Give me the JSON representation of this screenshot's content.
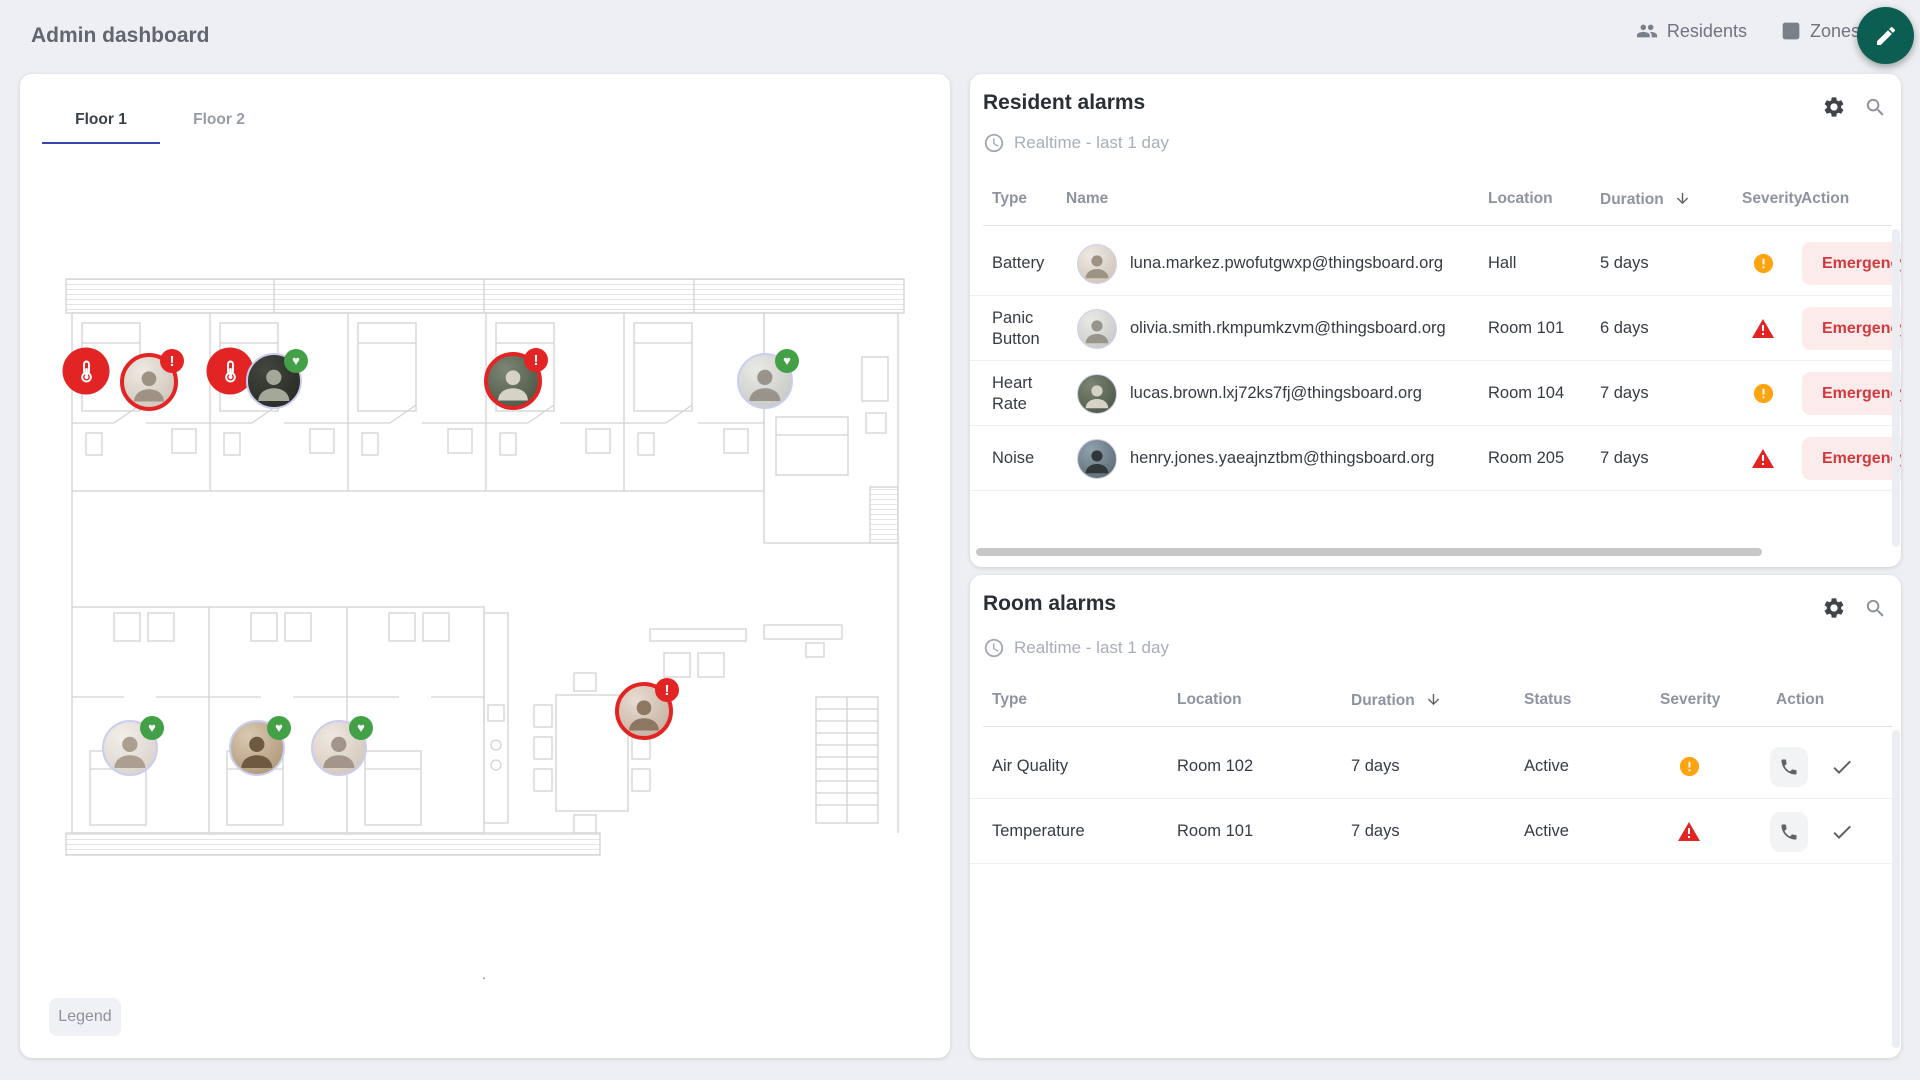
{
  "topbar": {
    "title": "Admin dashboard",
    "residents_button": "Residents",
    "zones_button": "Zones"
  },
  "floor": {
    "tabs": [
      {
        "label": "Floor 1",
        "active": true
      },
      {
        "label": "Floor 2",
        "active": false
      }
    ],
    "legend_button": "Legend",
    "dot_label": ".",
    "markers": [
      {
        "kind": "sensor",
        "icon": "thermometer-icon",
        "status": "alarm",
        "x": 22,
        "y": 94
      },
      {
        "kind": "resident",
        "photo": "woman-silver",
        "status": "alarm",
        "badge": "alert",
        "x": 85,
        "y": 105
      },
      {
        "kind": "sensor",
        "icon": "thermometer-icon",
        "status": "alarm",
        "x": 166,
        "y": 94
      },
      {
        "kind": "resident",
        "photo": "man-dark2",
        "status": "ok",
        "badge": "heart",
        "x": 210,
        "y": 104
      },
      {
        "kind": "resident",
        "photo": "man-gray",
        "status": "alarm",
        "badge": "alert",
        "x": 449,
        "y": 104
      },
      {
        "kind": "resident",
        "photo": "woman-white",
        "status": "ok",
        "badge": "heart",
        "x": 701,
        "y": 104
      },
      {
        "kind": "resident",
        "photo": "woman-glasses",
        "status": "ok",
        "badge": "heart",
        "x": 66,
        "y": 471
      },
      {
        "kind": "resident",
        "photo": "man-cap",
        "status": "ok",
        "badge": "heart",
        "x": 193,
        "y": 471
      },
      {
        "kind": "resident",
        "photo": "woman-2",
        "status": "ok",
        "badge": "heart",
        "x": 275,
        "y": 471
      },
      {
        "kind": "resident",
        "photo": "woman-gray",
        "status": "alarm",
        "badge": "alert",
        "x": 580,
        "y": 434
      }
    ]
  },
  "resident_alarms": {
    "title": "Resident alarms",
    "timewindow": "Realtime - last 1 day",
    "columns": {
      "type": "Type",
      "name": "Name",
      "location": "Location",
      "duration": "Duration",
      "severity": "Severity",
      "action": "Action"
    },
    "sorted_by": "Duration",
    "rows": [
      {
        "type": "Battery",
        "avatar": "woman-silver",
        "name": "luna.markez.pwofutgwxp@thingsboard.org",
        "location": "Hall",
        "duration": "5 days",
        "severity": "warning",
        "action": "Emergency"
      },
      {
        "type": "Panic Button",
        "avatar": "woman-white",
        "name": "olivia.smith.rkmpumkzvm@thingsboard.org",
        "location": "Room 101",
        "duration": "6 days",
        "severity": "critical",
        "action": "Emergency"
      },
      {
        "type": "Heart Rate",
        "avatar": "man-gray",
        "name": "lucas.brown.lxj72ks7fj@thingsboard.org",
        "location": "Room 104",
        "duration": "7 days",
        "severity": "warning",
        "action": "Emergency"
      },
      {
        "type": "Noise",
        "avatar": "man-dark",
        "name": "henry.jones.yaeajnztbm@thingsboard.org",
        "location": "Room 205",
        "duration": "7 days",
        "severity": "critical",
        "action": "Emergency"
      }
    ]
  },
  "room_alarms": {
    "title": "Room alarms",
    "timewindow": "Realtime - last 1 day",
    "columns": {
      "type": "Type",
      "location": "Location",
      "duration": "Duration",
      "status": "Status",
      "severity": "Severity",
      "action": "Action"
    },
    "sorted_by": "Duration",
    "rows": [
      {
        "type": "Air Quality",
        "location": "Room 102",
        "duration": "7 days",
        "status": "Active",
        "severity": "warning"
      },
      {
        "type": "Temperature",
        "location": "Room 101",
        "duration": "7 days",
        "status": "Active",
        "severity": "critical"
      }
    ]
  },
  "colors": {
    "critical": "#e32424",
    "warning": "#ffa411",
    "ok": "#43a047",
    "fab": "#0b5e51",
    "tab_accent": "#3a44b0",
    "emergency_bg": "#fcebeb",
    "emergency_text": "#d2393e"
  }
}
